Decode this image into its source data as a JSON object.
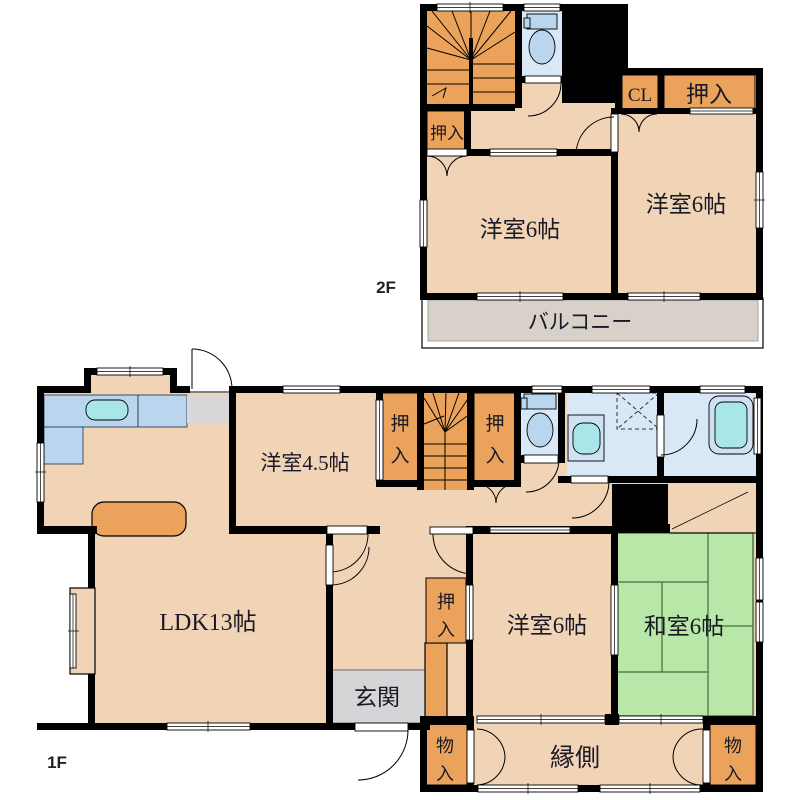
{
  "palette": {
    "wall": "#000000",
    "room_peach": "#f1d3b5",
    "closet_orange": "#eba35c",
    "tatami_green": "#b9e7a7",
    "sanitary_blue": "#d9e8f6",
    "fixture_blue": "#b9d6ee",
    "water_cyan": "#a8e6ea",
    "genkan_gray": "#d5d5d8",
    "balcony_gray": "#d7d1ca"
  },
  "floor2": {
    "label": "2F",
    "rooms": {
      "western_left": "洋室6帖",
      "western_right": "洋室6帖",
      "closet_left": "押入",
      "closet_top": "押入",
      "cl": "CL",
      "balcony": "バルコニー"
    }
  },
  "floor1": {
    "label": "1F",
    "rooms": {
      "ldk": "LDK13帖",
      "western45": "洋室4.5帖",
      "western6": "洋室6帖",
      "japanese6": "和室6帖",
      "genkan": "玄関",
      "engawa": "縁側"
    },
    "closets": {
      "a": [
        "押",
        "入"
      ],
      "b": [
        "押",
        "入"
      ],
      "c": [
        "押",
        "入"
      ]
    },
    "storages": {
      "left": [
        "物",
        "入"
      ],
      "right": [
        "物",
        "入"
      ]
    }
  }
}
